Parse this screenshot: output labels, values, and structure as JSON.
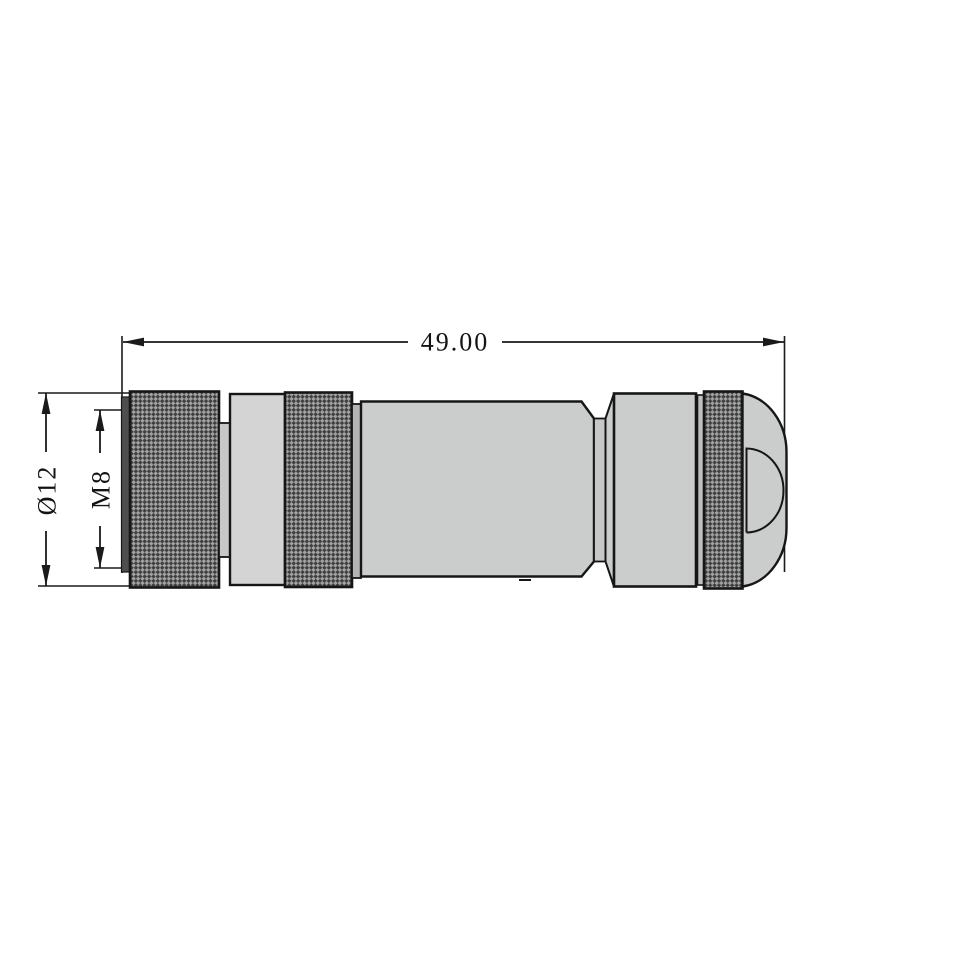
{
  "drawing": {
    "title": "M8 circular connector - dimensioned side view",
    "labels": {
      "length": "49.00",
      "outer_diameter": "Ø12",
      "thread": "M8"
    },
    "colors": {
      "background": "#ffffff",
      "line": "#1a1a1a",
      "body_fill": "#cbcdcc",
      "collar_fill": "#d3d4d3",
      "recess_fill": "#c0c1c0",
      "step_fill": "#b3b4b3",
      "dark_face_fill": "#4e4e4e",
      "knurl_light": "#a2a3a2",
      "knurl_dark": "#3e3e3e"
    }
  }
}
